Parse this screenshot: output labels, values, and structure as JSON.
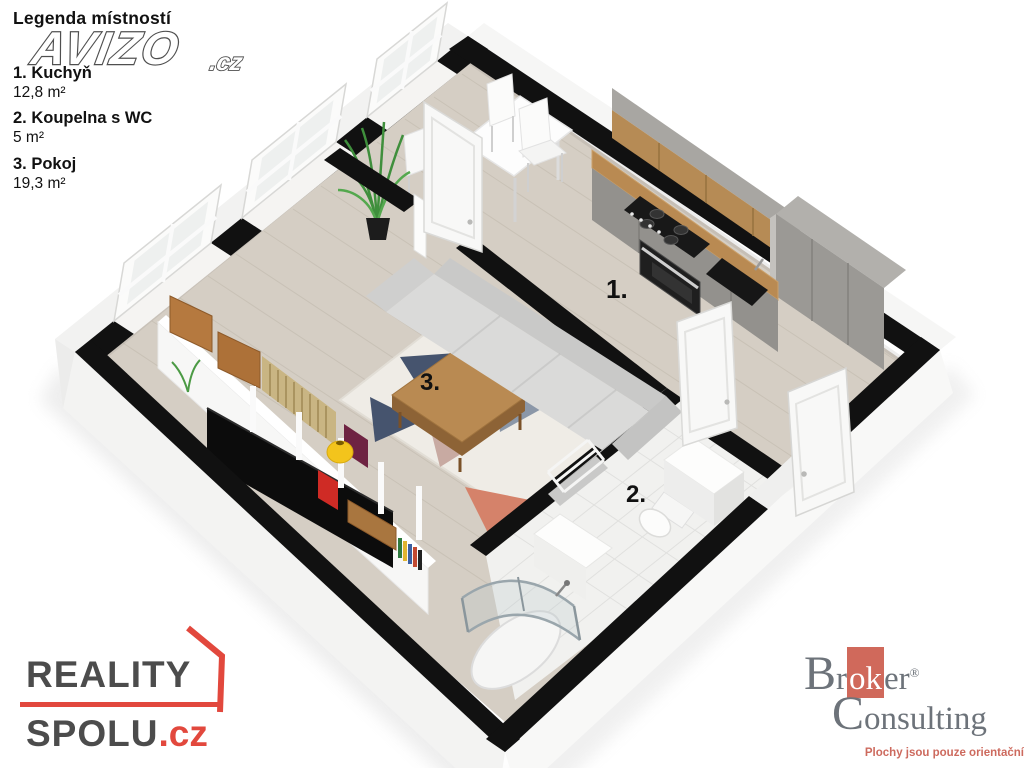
{
  "legend": {
    "title": "Legenda místností",
    "items": [
      {
        "label": "1. Kuchyň",
        "area": "12,8 m²"
      },
      {
        "label": "2. Koupelna  s WC",
        "area": "5 m²"
      },
      {
        "label": "3. Pokoj",
        "area": "19,3 m²"
      }
    ]
  },
  "watermark": {
    "name": "AVIZO",
    "tld": ".cz"
  },
  "plan": {
    "room_labels": {
      "kitchen": "1.",
      "bathroom": "2.",
      "living_room": "3."
    }
  },
  "logo_reality_spolu": {
    "line1": "REALITY",
    "line2": "SPOLU",
    "tld": ".cz"
  },
  "logo_broker": {
    "cap1": "B",
    "pre": "r",
    "highlight": "ok",
    "post": "er",
    "registered": "®",
    "cap2": "C",
    "line2rest": "onsulting",
    "tagline": "Plochy jsou pouze orientační"
  },
  "colors": {
    "wall_cut": "#111111",
    "floor_wood": "#d5cec4",
    "tile": "#f1f1ef",
    "cabinet_gray": "#95938f",
    "counter_wood": "#b98a52",
    "sofa_gray": "#d6d6d5",
    "rug_navy": "#46546e",
    "rug_slate": "#8b97a8",
    "rug_blush": "#c8aaa2",
    "rug_salmon": "#d5826a",
    "vase_yellow": "#f3c41c",
    "reality_red": "#e2483d",
    "broker_red": "#cd6a5e"
  }
}
